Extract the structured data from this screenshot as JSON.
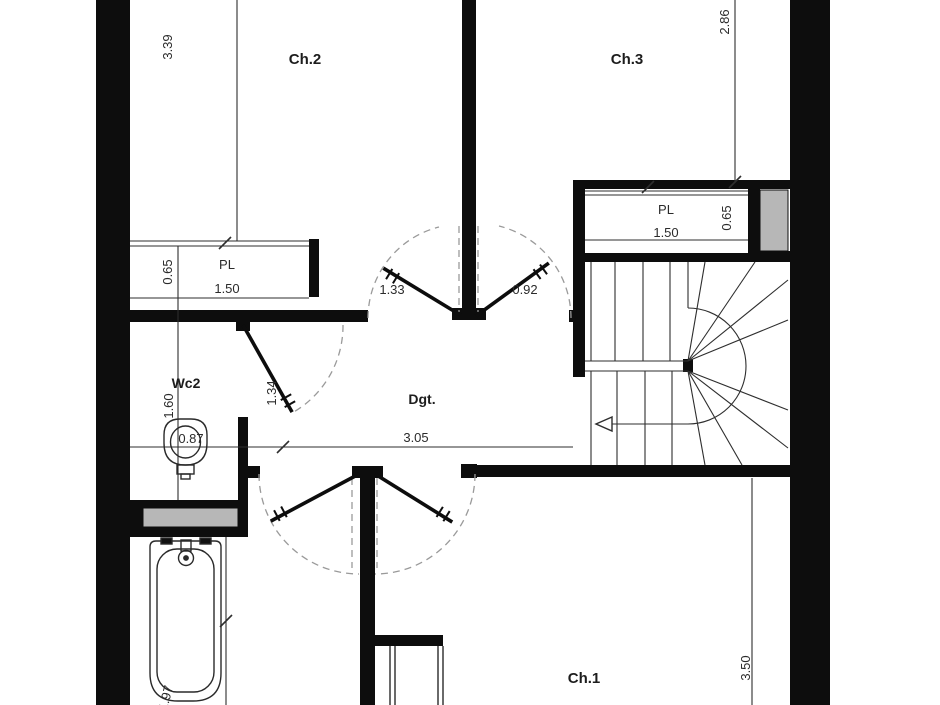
{
  "plan": {
    "title": "floor-plan-bedroom-level",
    "labels": {
      "ch2": "Ch.2",
      "ch3": "Ch.3",
      "ch1": "Ch.1",
      "wc2": "Wc2",
      "hall": "Dgt.",
      "closet_left": "PL",
      "closet_right": "PL"
    },
    "dimensions": {
      "ch2_height": "3.39",
      "ch3_height": "2.86",
      "closet_left_depth": "0.65",
      "closet_left_width": "1.50",
      "closet_right_depth": "0.65",
      "closet_right_width": "1.50",
      "door_ch2": "1.33",
      "door_ch3": "0.92",
      "door_wc2": "1.34",
      "wc2_depth": "1.60",
      "wc2_width": "0.87",
      "hall_width": "3.05",
      "ch1_height": "3.50",
      "bath_length": "1.97"
    }
  },
  "colors": {
    "wall": "#0d0d0d",
    "shaft_fill": "#b7b7b7",
    "line": "#2e2e2e",
    "dashed": "#9a9a9a",
    "background": "#ffffff"
  }
}
